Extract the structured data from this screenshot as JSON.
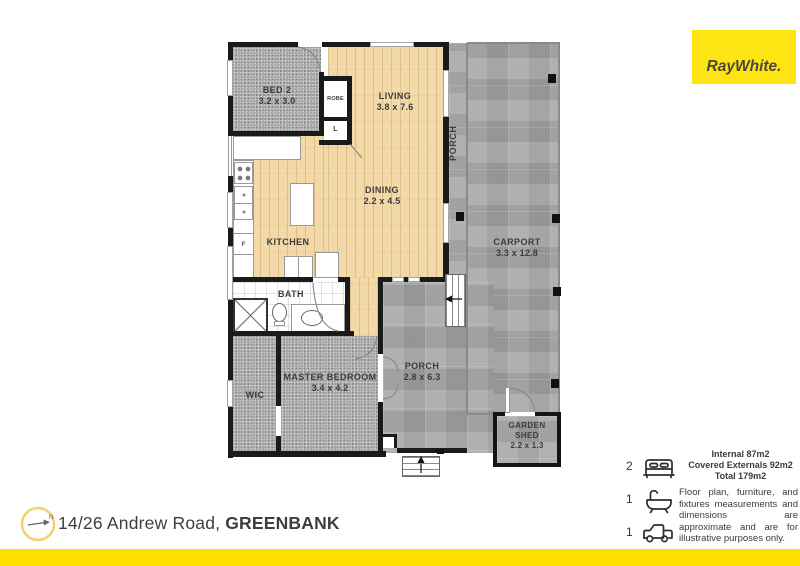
{
  "brand": {
    "logo_text": "RayWhite.",
    "logo_bg": "#ffe414"
  },
  "plan": {
    "rooms": {
      "bed2": {
        "label": "BED 2",
        "dims": "3.2 x 3.0"
      },
      "robe": {
        "label": "ROBE"
      },
      "linen": {
        "label": "L"
      },
      "living": {
        "label": "LIVING",
        "dims": "3.8 x 7.6"
      },
      "dining": {
        "label": "DINING",
        "dims": "2.2 x 4.5"
      },
      "kitchen": {
        "label": "KITCHEN"
      },
      "bath": {
        "label": "BATH"
      },
      "wic": {
        "label": "WIC"
      },
      "master": {
        "label": "MASTER BEDROOM",
        "dims": "3.4 x 4.2"
      },
      "porch_side": {
        "label": "PORCH"
      },
      "porch_rear": {
        "label": "PORCH",
        "dims": "2.8 x 6.3"
      },
      "carport": {
        "label": "CARPORT",
        "dims": "3.3 x 12.8"
      },
      "garden_shed": {
        "label": "GARDEN SHED",
        "dims": "2.2 x 1.3"
      }
    },
    "fixtures": {
      "fridge": "F"
    }
  },
  "footer": {
    "address_prefix": "14/26 Andrew Road,",
    "address_suburb": "GREENBANK",
    "compass_label": "N"
  },
  "legend": {
    "beds": "2",
    "baths": "1",
    "cars": "1",
    "areas": [
      "Internal 87m2",
      "Covered Externals 92m2",
      "Total 179m2"
    ],
    "disclaimer": "Floor plan, furniture, and fixtures measurements and dimensions are approximate and are for illustrative purposes only."
  },
  "colors": {
    "brand_yellow": "#ffdf00",
    "wall": "#1a1a1a",
    "wood": "#f3d9a8",
    "carpet": "#a7a7a7",
    "concrete": "#a2a2a2"
  }
}
